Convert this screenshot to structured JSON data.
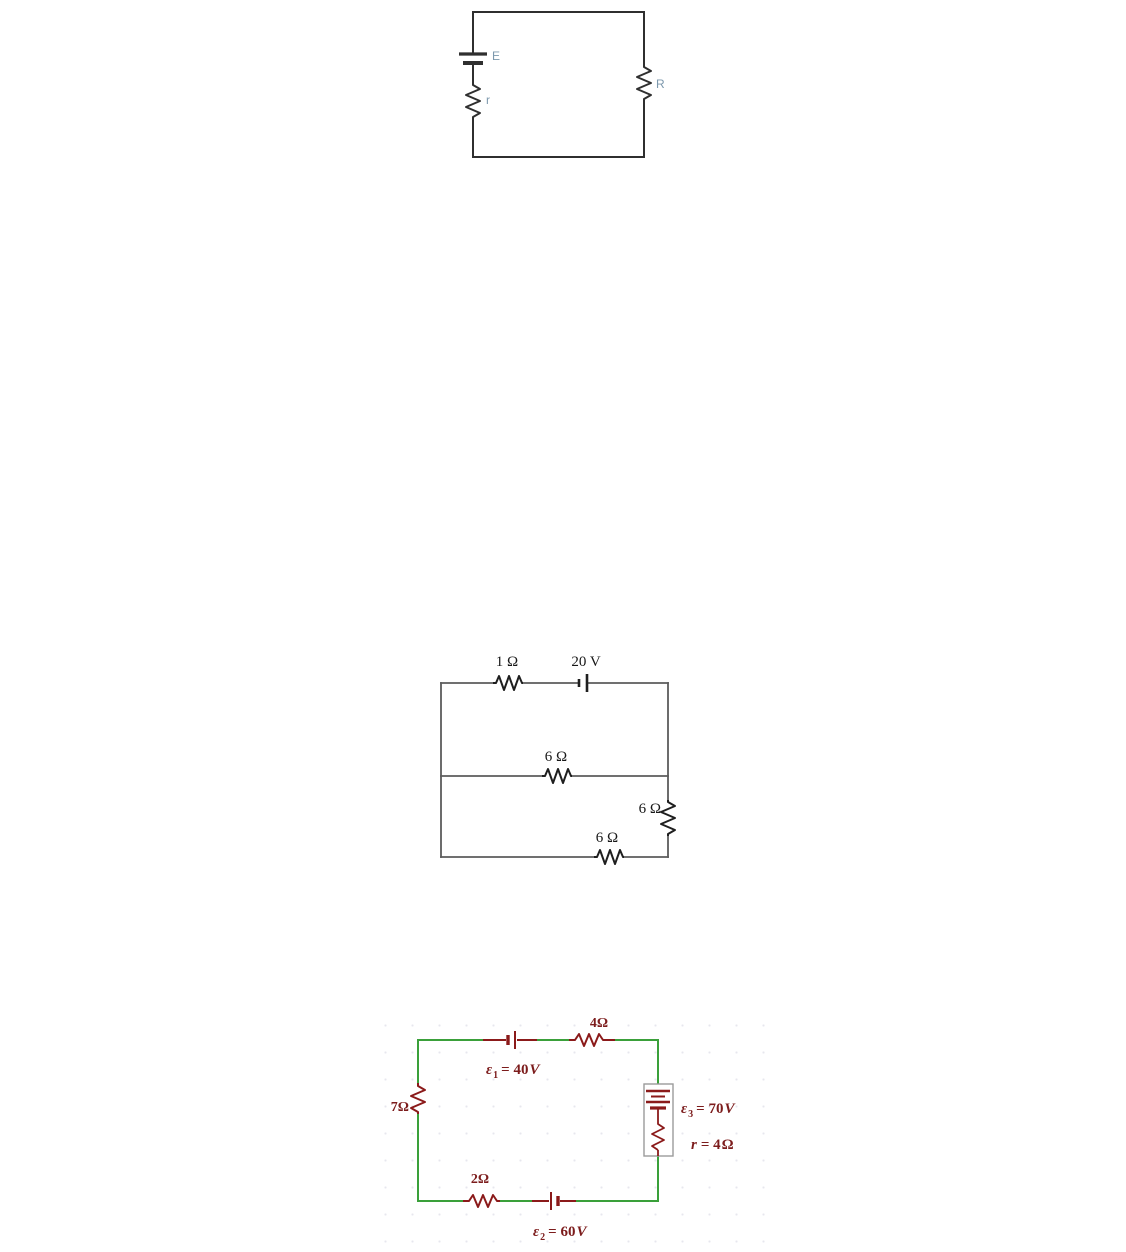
{
  "colors": {
    "circuit1_wire": "#2f2f2f",
    "circuit1_label": "#7c98ad",
    "circuit2_wire": "#5c5c5c",
    "circuit2_component": "#1f1f1f",
    "circuit2_label": "#171717",
    "circuit3_wire": "#3aa03a",
    "circuit3_component": "#8b1a1a",
    "circuit3_label": "#7c1c1c",
    "circuit3_box_border": "#9b9b9b"
  },
  "circuit1": {
    "labels": {
      "emf": "E",
      "internal_resistance": "r",
      "load": "R"
    }
  },
  "circuit2": {
    "labels": {
      "top_resistor": "1 Ω",
      "battery": "20 V",
      "middle_resistor": "6 Ω",
      "right_resistor": "6 Ω",
      "bottom_resistor": "6 Ω"
    }
  },
  "circuit3": {
    "labels": {
      "top_resistor": "4Ω",
      "left_resistor": "7Ω",
      "bottom_resistor": "2Ω",
      "emf1": {
        "sym": "ε",
        "sub": "1",
        "eq": "= 40",
        "unit": "V"
      },
      "emf2": {
        "sym": "ε",
        "sub": "2",
        "eq": "= 60",
        "unit": "V"
      },
      "emf3": {
        "sym": "ε",
        "sub": "3",
        "eq": "= 70",
        "unit": "V"
      },
      "internal": {
        "sym": "r",
        "eq": "= 4",
        "unit": "Ω"
      }
    }
  }
}
